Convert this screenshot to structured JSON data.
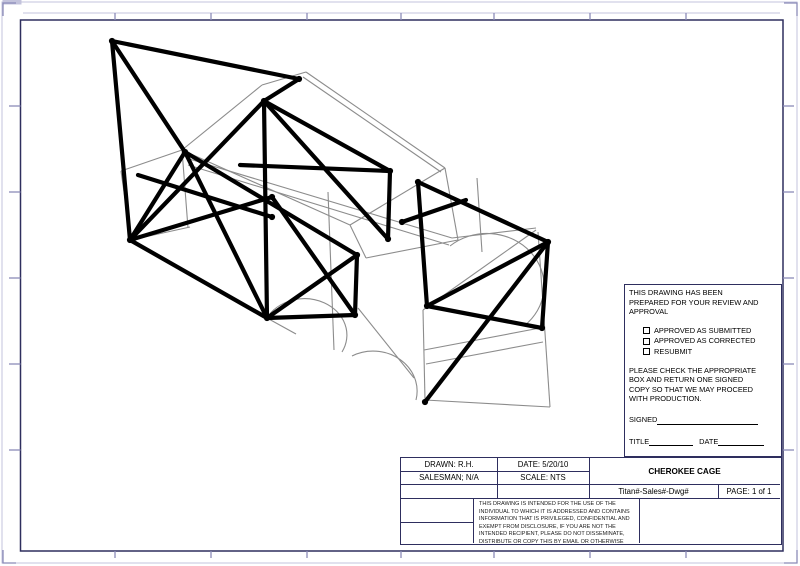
{
  "sheet": {
    "frame_color": "#2e2e5e",
    "tick_color": "#8b8bb8",
    "outer_edge_color": "#c3c3dc",
    "frame": {
      "x1": 20.5,
      "y1": 20,
      "x2": 783,
      "y2": 551
    },
    "ticks": {
      "top_bottom_x": [
        115,
        211,
        307,
        401,
        494,
        590,
        686
      ],
      "left_right_y": [
        106,
        192,
        278,
        364,
        450
      ]
    }
  },
  "drawing": {
    "cage_color": "#000000",
    "body_color": "#8c8c8c",
    "cage_width": 4.2,
    "body_width": 1.1,
    "cage_segments": [
      [
        112,
        41,
        130,
        240
      ],
      [
        112,
        41,
        299,
        79
      ],
      [
        112,
        41,
        185,
        152
      ],
      [
        185,
        152,
        130,
        240
      ],
      [
        130,
        240,
        264,
        101
      ],
      [
        264,
        101,
        299,
        79
      ],
      [
        264,
        101,
        267,
        318
      ],
      [
        240,
        165,
        390,
        171
      ],
      [
        390,
        171,
        388,
        239
      ],
      [
        264,
        101,
        390,
        171
      ],
      [
        264,
        101,
        388,
        239
      ],
      [
        185,
        152,
        357,
        255
      ],
      [
        138,
        175,
        272,
        217
      ],
      [
        130,
        240,
        267,
        318
      ],
      [
        185,
        152,
        267,
        318
      ],
      [
        130,
        240,
        272,
        197
      ],
      [
        272,
        197,
        355,
        315
      ],
      [
        267,
        318,
        357,
        255
      ],
      [
        267,
        318,
        355,
        315
      ],
      [
        357,
        255,
        355,
        315
      ],
      [
        418,
        182,
        427,
        306
      ],
      [
        402,
        222,
        466,
        200
      ],
      [
        418,
        182,
        548,
        242
      ],
      [
        427,
        306,
        548,
        242
      ],
      [
        425,
        402,
        548,
        242
      ],
      [
        427,
        306,
        542,
        328
      ],
      [
        548,
        242,
        542,
        328
      ]
    ],
    "joints": [
      [
        112,
        41
      ],
      [
        299,
        79
      ],
      [
        264,
        101
      ],
      [
        130,
        240
      ],
      [
        185,
        152
      ],
      [
        272,
        197
      ],
      [
        267,
        318
      ],
      [
        357,
        255
      ],
      [
        355,
        315
      ],
      [
        390,
        171
      ],
      [
        388,
        239
      ],
      [
        418,
        182
      ],
      [
        427,
        306
      ],
      [
        548,
        242
      ],
      [
        425,
        402
      ],
      [
        542,
        328
      ],
      [
        402,
        222
      ],
      [
        272,
        217
      ]
    ],
    "body_segments": [
      [
        121,
        171,
        131,
        240
      ],
      [
        121,
        171,
        182,
        150
      ],
      [
        182,
        150,
        188,
        228
      ],
      [
        131,
        240,
        190,
        227
      ],
      [
        182,
        150,
        262,
        85
      ],
      [
        262,
        85,
        306,
        72
      ],
      [
        306,
        72,
        445,
        168
      ],
      [
        303,
        77,
        441,
        172
      ],
      [
        182,
        150,
        350,
        225
      ],
      [
        350,
        225,
        445,
        168
      ],
      [
        186,
        158,
        452,
        238
      ],
      [
        188,
        165,
        449,
        245
      ],
      [
        445,
        168,
        458,
        240
      ],
      [
        350,
        225,
        366,
        258
      ],
      [
        366,
        258,
        458,
        240
      ],
      [
        328,
        192,
        334,
        350
      ],
      [
        477,
        178,
        482,
        252
      ],
      [
        131,
        240,
        267,
        318
      ],
      [
        267,
        318,
        296,
        334
      ],
      [
        452,
        238,
        536,
        228
      ],
      [
        538,
        232,
        545,
        333
      ],
      [
        545,
        333,
        550,
        407
      ],
      [
        425,
        400,
        550,
        407
      ],
      [
        423,
        310,
        425,
        400
      ],
      [
        423,
        310,
        536,
        230
      ],
      [
        424,
        350,
        540,
        328
      ],
      [
        426,
        364,
        543,
        342
      ],
      [
        358,
        308,
        414,
        378
      ]
    ],
    "body_arcs": [
      "M 267 318 A 42 36 0 0 1 342 352",
      "M 352 356 A 44 40 0 0 1 416 400",
      "M 450 246 A 50 46 0 0 1 524 326"
    ]
  },
  "approval": {
    "intro": "THIS DRAWING HAS BEEN\nPREPARED FOR YOUR REVIEW AND\nAPPROVAL",
    "checkboxes": [
      "APPROVED AS SUBMITTED",
      "APPROVED AS CORRECTED",
      "RESUBMIT"
    ],
    "note": "PLEASE CHECK THE APPROPRIATE\nBOX AND RETURN ONE SIGNED\nCOPY SO THAT WE MAY PROCEED\nWITH PRODUCTION.",
    "signed_label": "SIGNED",
    "title_label": "TITLE",
    "date_label": "DATE"
  },
  "title_block": {
    "drawn": "DRAWN: R.H.",
    "date": "DATE: 5/20/10",
    "salesman": "SALESMAN; N/A",
    "scale": "SCALE: NTS",
    "project": "CHEROKEE CAGE",
    "doc_code": "Titan#-Sales#-Dwg#",
    "page": "PAGE: 1 of 1"
  },
  "disclaimer": "THIS DRAWING IS INTENDED FOR THE USE OF THE\nINDIVIDUAL TO WHICH IT IS ADDRESSED AND CONTAINS\nINFORMATION THAT IS PRIVILEGED, CONFIDENTIAL AND\nEXEMPT FROM DISCLOSURE, IF YOU ARE NOT THE\nINTENDED RECIPIENT, PLEASE DO NOT DISSEMINATE,\nDISTRIBUTE OR COPY THIS BY EMAIL OR OTHERWISE"
}
